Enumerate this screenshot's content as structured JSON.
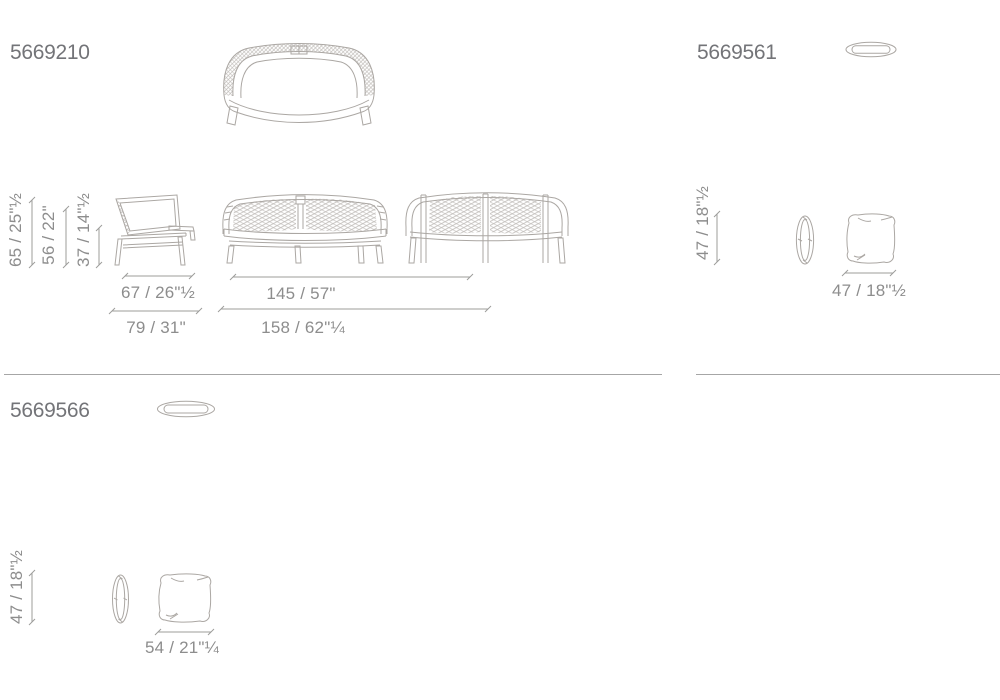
{
  "sheet": {
    "background": "#ffffff",
    "colors": {
      "drawing_stroke": "#aba7a3",
      "weave_stroke": "#b6b2ae",
      "dim_line": "#9c9c9a",
      "dim_text": "#8d8d8d",
      "code_text": "#737478",
      "divider": "#a6a6a6"
    },
    "products": {
      "sofa": {
        "code": "5669210",
        "height_total": "65 / 25\"½",
        "height_back": "56 / 22\"",
        "height_seat": "37 / 14\"½",
        "depth_seat": "67 / 26\"½",
        "depth_total": "79 / 31\"",
        "width_seat": "145 / 57\"",
        "width_total": "158 / 62\"¼"
      },
      "pouf_small": {
        "code": "5669561",
        "height": "47 / 18\"½",
        "width": "47 / 18\"½"
      },
      "pouf_large": {
        "code": "5669566",
        "height": "47 / 18\"½",
        "width": "54 / 21\"¼"
      }
    }
  }
}
